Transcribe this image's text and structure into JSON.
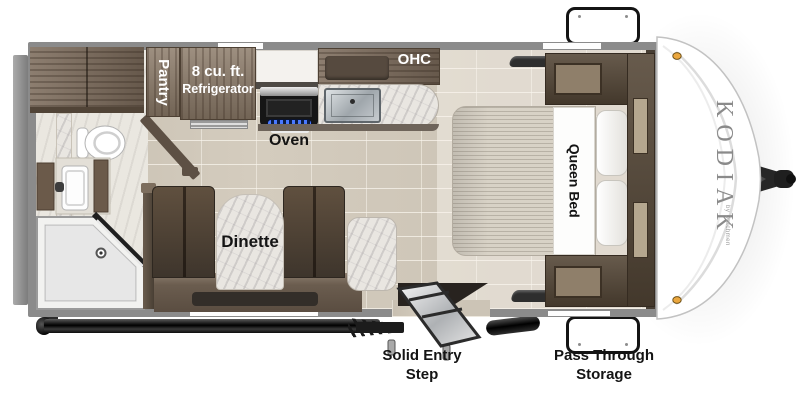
{
  "brand": {
    "name": "KODIAK",
    "byline": "by Dutchmen"
  },
  "labels": {
    "pantry": "Pantry",
    "refrigerator": [
      "8 cu. ft.",
      "Refrigerator"
    ],
    "ohc": "OHC",
    "oven": "Oven",
    "dinette": "Dinette",
    "queen_bed": "Queen Bed",
    "entry_step": [
      "Solid Entry",
      "Step"
    ],
    "storage": [
      "Pass Through",
      "Storage"
    ]
  },
  "colors": {
    "wall_gray": "#8b8b8b",
    "floor_tile": "#d4ccbe",
    "wood_light": "#8b7a68",
    "wood_dark": "#564838",
    "bench_brown": "#4e4339",
    "marble": "#e9e6e1",
    "burner_blue": "#4a79ff",
    "brand_text": "#8a8a8a",
    "clearance_light": "#eba73e"
  }
}
